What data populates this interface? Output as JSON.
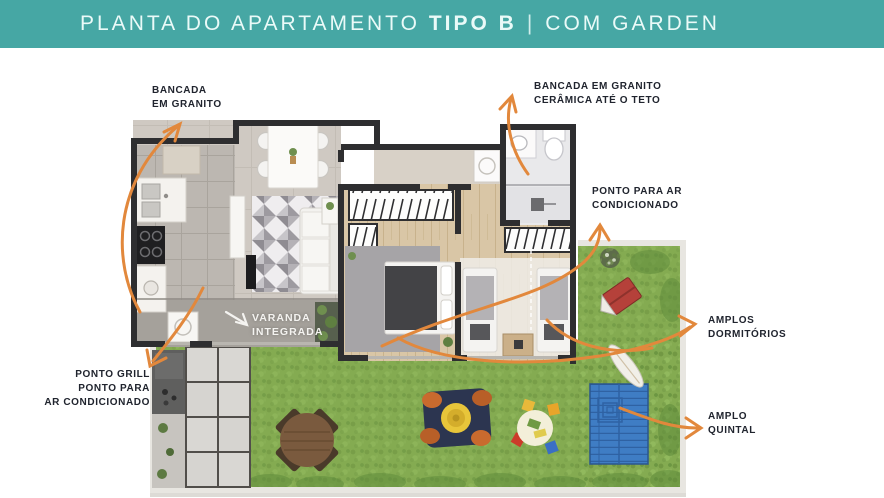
{
  "header": {
    "title_prefix": "PLANTA DO APARTAMENTO",
    "title_bold": "TIPO B",
    "separator": "|",
    "title_suffix": "COM GARDEN"
  },
  "annotations": {
    "bancada_left": {
      "lines": [
        "BANCADA",
        "EM GRANITO"
      ]
    },
    "bancada_right": {
      "lines": [
        "BANCADA EM GRANITO",
        "CERÂMICA ATÉ O TETO"
      ]
    },
    "ponto_ar": {
      "lines": [
        "PONTO PARA AR",
        "CONDICIONADO"
      ]
    },
    "amplos": {
      "lines": [
        "AMPLOS",
        "DORMITÓRIOS"
      ]
    },
    "quintal": {
      "lines": [
        "AMPLO",
        "QUINTAL"
      ]
    },
    "grill": {
      "lines": [
        "PONTO GRILL",
        "PONTO PARA",
        "AR CONDICIONADO"
      ]
    }
  },
  "plan": {
    "varanda_label": {
      "lines": [
        "VARANDA",
        "INTEGRADA"
      ]
    }
  },
  "colors": {
    "header_bg": "#46a7a4",
    "arrow_orange": "#e2883c",
    "label_ink": "#20242e",
    "grass_green": "#84ab51",
    "deck_blue": "#3f7dc4",
    "wall_dark": "#2e2e30",
    "wood_floor": "#d9c6a6",
    "curb_gray": "#e8e6e1"
  }
}
